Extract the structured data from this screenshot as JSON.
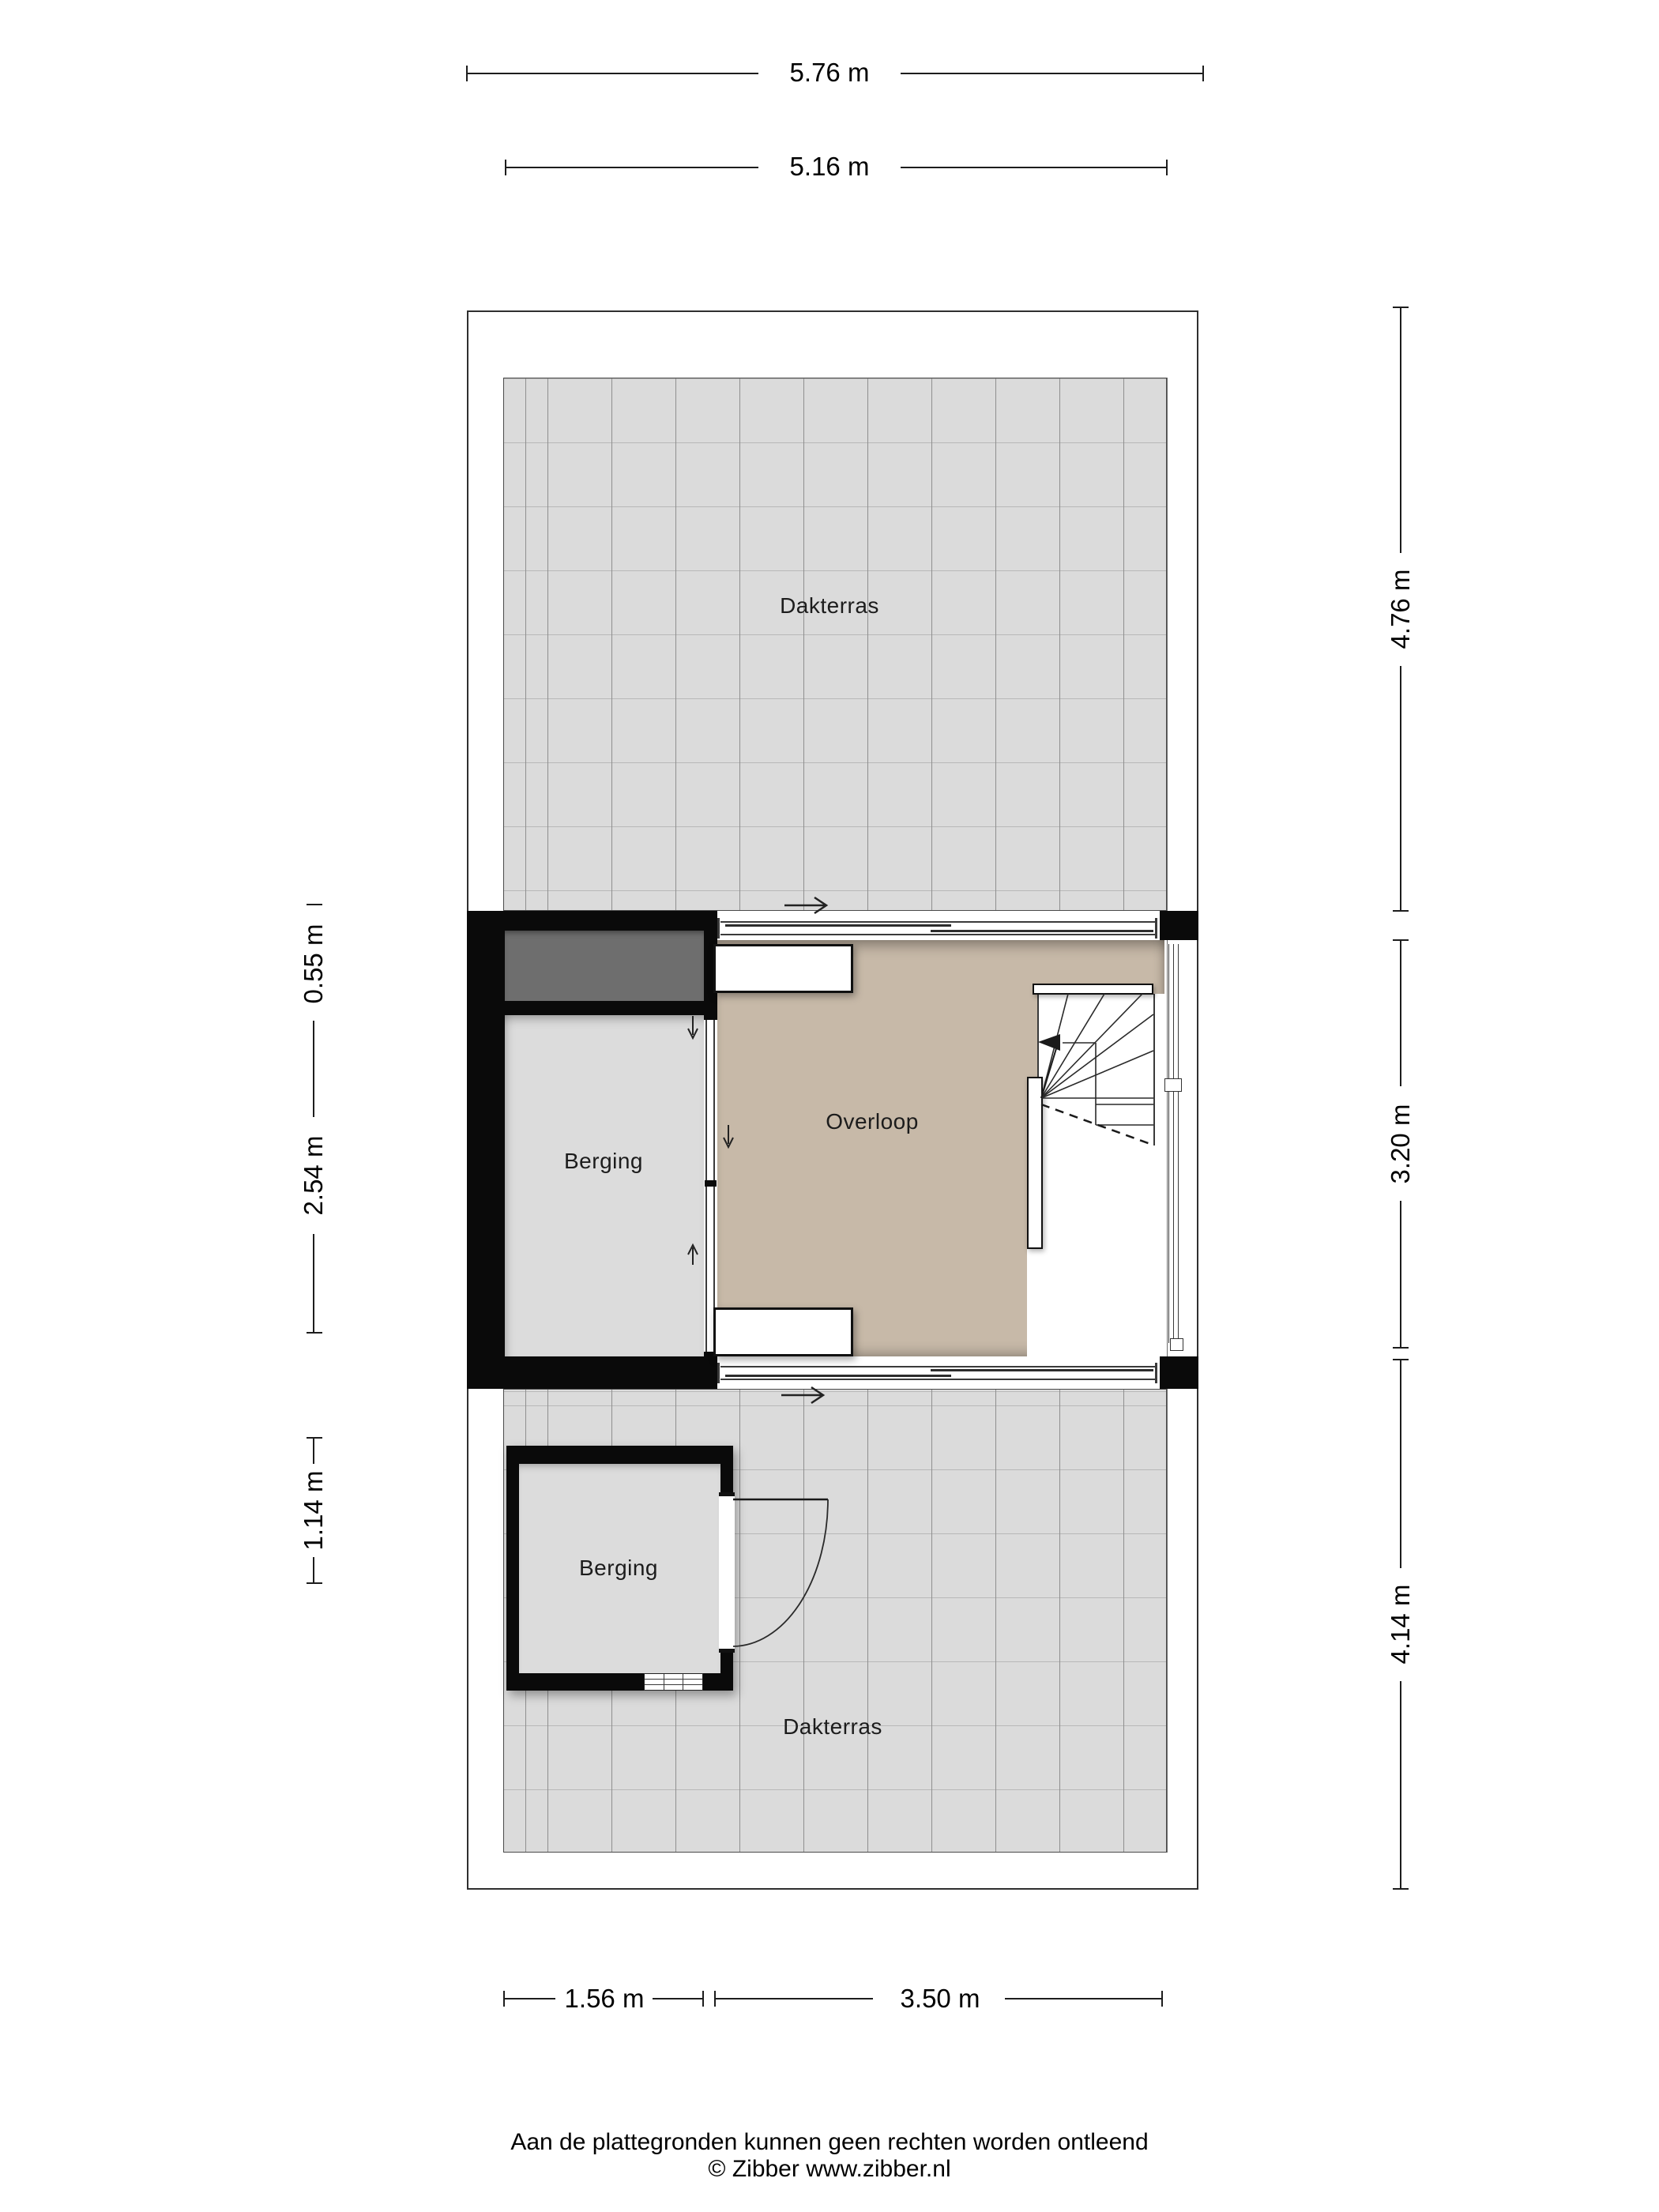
{
  "rooms": {
    "dakterras_top": "Dakterras",
    "overloop": "Overloop",
    "berging_middle": "Berging",
    "berging_lower": "Berging",
    "dakterras_bottom": "Dakterras"
  },
  "dimensions": {
    "top_outer_width": "5.76 m",
    "top_inner_width": "5.16 m",
    "right_top": "4.76 m",
    "right_middle": "3.20 m",
    "right_bottom": "4.14 m",
    "left_upper": "0.55 m",
    "left_middle": "2.54 m",
    "left_lower": "1.14 m",
    "bottom_left": "1.56 m",
    "bottom_right": "3.50 m"
  },
  "footer": {
    "line1": "Aan de plattegronden kunnen geen rechten worden ontleend",
    "line2": "© Zibber www.zibber.nl"
  },
  "colors": {
    "wall": "#0a0a0a",
    "terrace_tile": "#dbdbdb",
    "room_gray": "#dcdcdc",
    "overloop_floor": "#c7b9a8",
    "dark_niche": "#6e6e6e",
    "dimension_line": "#1d1d1d"
  }
}
